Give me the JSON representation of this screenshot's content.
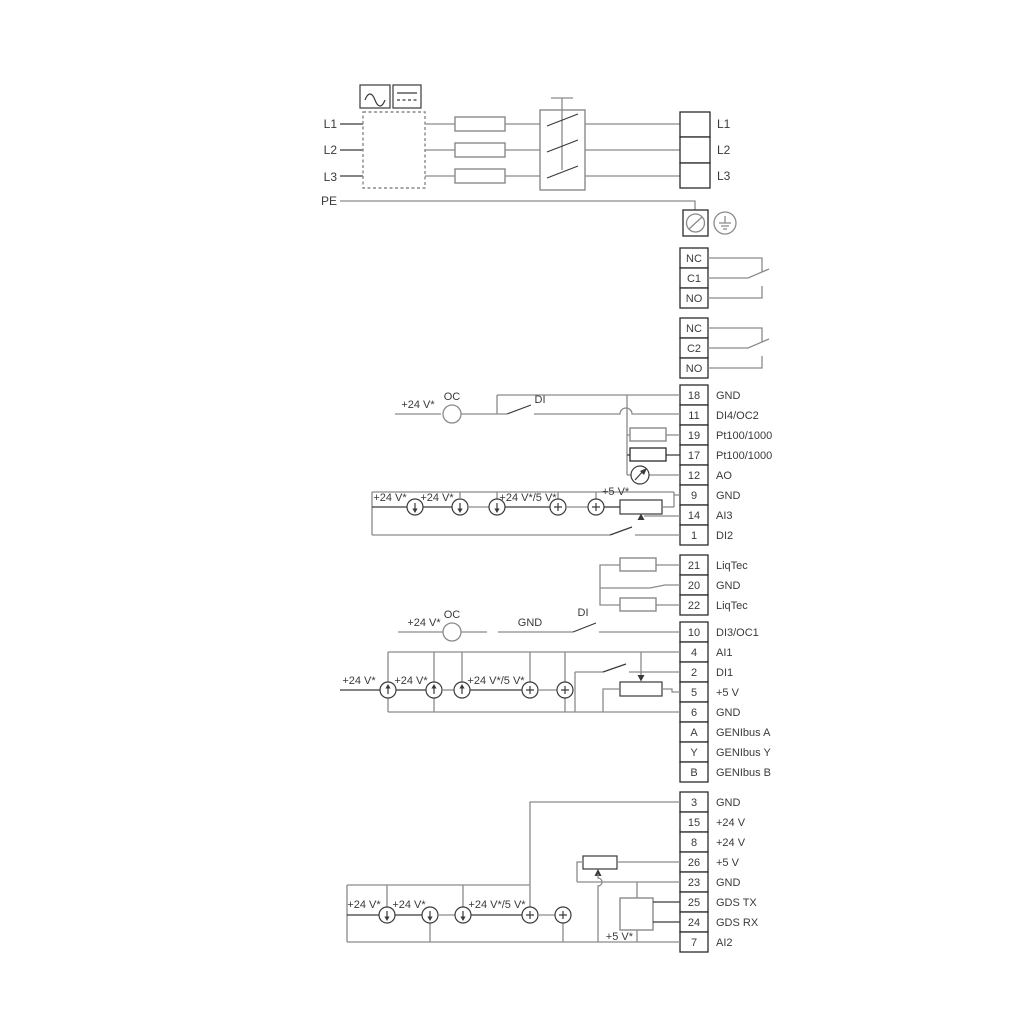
{
  "labels": {
    "plus24": "+24 V*",
    "plus24or5": "+24 V*/5 V*",
    "plus5": "+5 V*",
    "oc": "OC",
    "di": "DI",
    "gnd": "GND"
  },
  "power": {
    "left": [
      "L1",
      "L2",
      "L3",
      "PE"
    ],
    "right": [
      "L1",
      "L2",
      "L3"
    ]
  },
  "relay1": [
    "NC",
    "C1",
    "NO"
  ],
  "relay2": [
    "NC",
    "C2",
    "NO"
  ],
  "group1": [
    {
      "n": "18",
      "l": "GND"
    },
    {
      "n": "11",
      "l": "DI4/OC2"
    },
    {
      "n": "19",
      "l": "Pt100/1000"
    },
    {
      "n": "17",
      "l": "Pt100/1000"
    },
    {
      "n": "12",
      "l": "AO"
    },
    {
      "n": "9",
      "l": "GND"
    },
    {
      "n": "14",
      "l": "AI3"
    },
    {
      "n": "1",
      "l": "DI2"
    }
  ],
  "liqtec": [
    {
      "n": "21",
      "l": "LiqTec"
    },
    {
      "n": "20",
      "l": "GND"
    },
    {
      "n": "22",
      "l": "LiqTec"
    }
  ],
  "group2": [
    {
      "n": "10",
      "l": "DI3/OC1"
    },
    {
      "n": "4",
      "l": "AI1"
    },
    {
      "n": "2",
      "l": "DI1"
    },
    {
      "n": "5",
      "l": "+5 V"
    },
    {
      "n": "6",
      "l": "GND"
    },
    {
      "n": "A",
      "l": "GENIbus A"
    },
    {
      "n": "Y",
      "l": "GENIbus Y"
    },
    {
      "n": "B",
      "l": "GENIbus B"
    }
  ],
  "group3": [
    {
      "n": "3",
      "l": "GND"
    },
    {
      "n": "15",
      "l": "+24 V"
    },
    {
      "n": "8",
      "l": "+24 V"
    },
    {
      "n": "26",
      "l": "+5 V"
    },
    {
      "n": "23",
      "l": "GND"
    },
    {
      "n": "25",
      "l": "GDS TX"
    },
    {
      "n": "24",
      "l": "GDS RX"
    },
    {
      "n": "7",
      "l": "AI2"
    }
  ],
  "colors": {
    "line_gray": "#8a8a8a",
    "line_dark": "#3a3a3a",
    "background": "#ffffff"
  }
}
